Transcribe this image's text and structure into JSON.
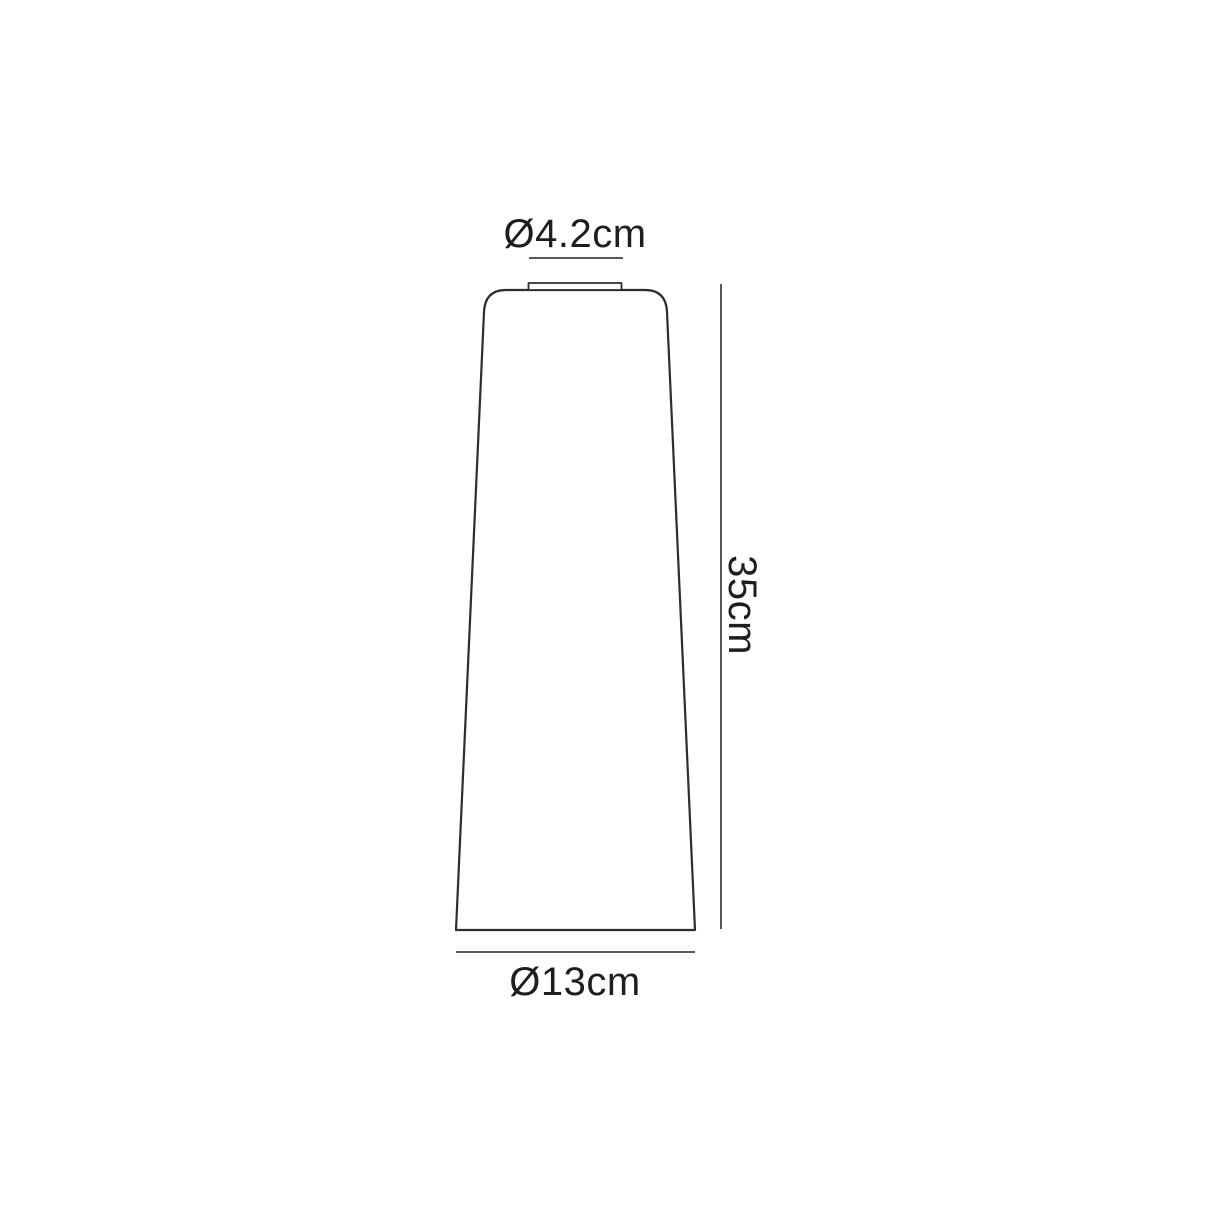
{
  "diagram": {
    "kind": "technical-dimension-drawing",
    "subject": "tapered cylindrical shade, front elevation with dimensions",
    "labels": {
      "top_diameter": "Ø4.2cm",
      "height": "35cm",
      "bottom_diameter": "Ø13cm"
    },
    "dimensions": {
      "top_diameter_cm": 4.2,
      "height_cm": 35,
      "bottom_diameter_cm": 13,
      "unit": "cm"
    },
    "colors": {
      "background": "#ffffff",
      "outline": "#2d2d2d",
      "dimension_line": "#595959",
      "text": "#1e1e1e",
      "shape_fill": "#ffffff"
    }
  }
}
